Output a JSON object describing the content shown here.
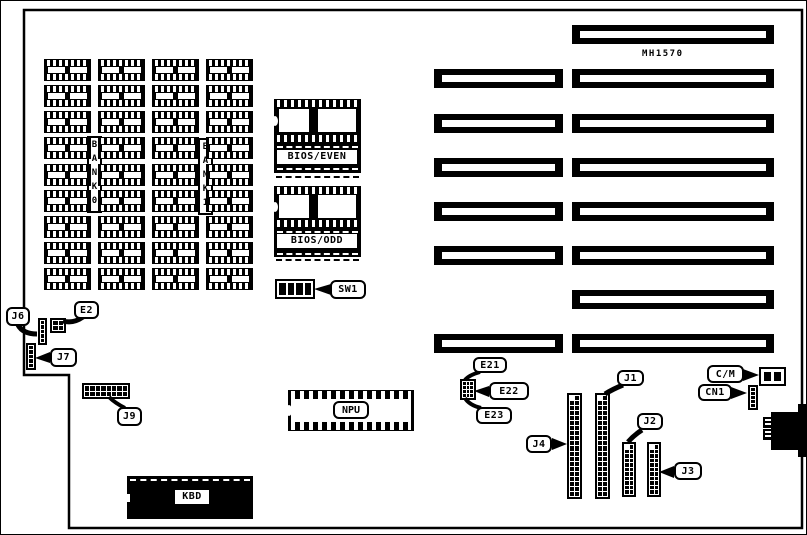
{
  "board": {
    "model": "MH1570",
    "memory_banks": {
      "bank0": "BANK0",
      "bank1": "BANK1"
    },
    "chips": {
      "bios_even": "BIOS/EVEN",
      "bios_odd": "BIOS/ODD",
      "npu": "NPU",
      "kbd": "KBD"
    },
    "callouts": {
      "j6": "J6",
      "e2": "E2",
      "j7": "J7",
      "j9": "J9",
      "sw1": "SW1",
      "e21": "E21",
      "e22": "E22",
      "e23": "E23",
      "j1": "J1",
      "j2": "J2",
      "j3": "J3",
      "j4": "J4",
      "cm": "C/M",
      "cn1": "CN1"
    },
    "colors": {
      "ink": "#000000",
      "background": "#ffffff"
    }
  }
}
